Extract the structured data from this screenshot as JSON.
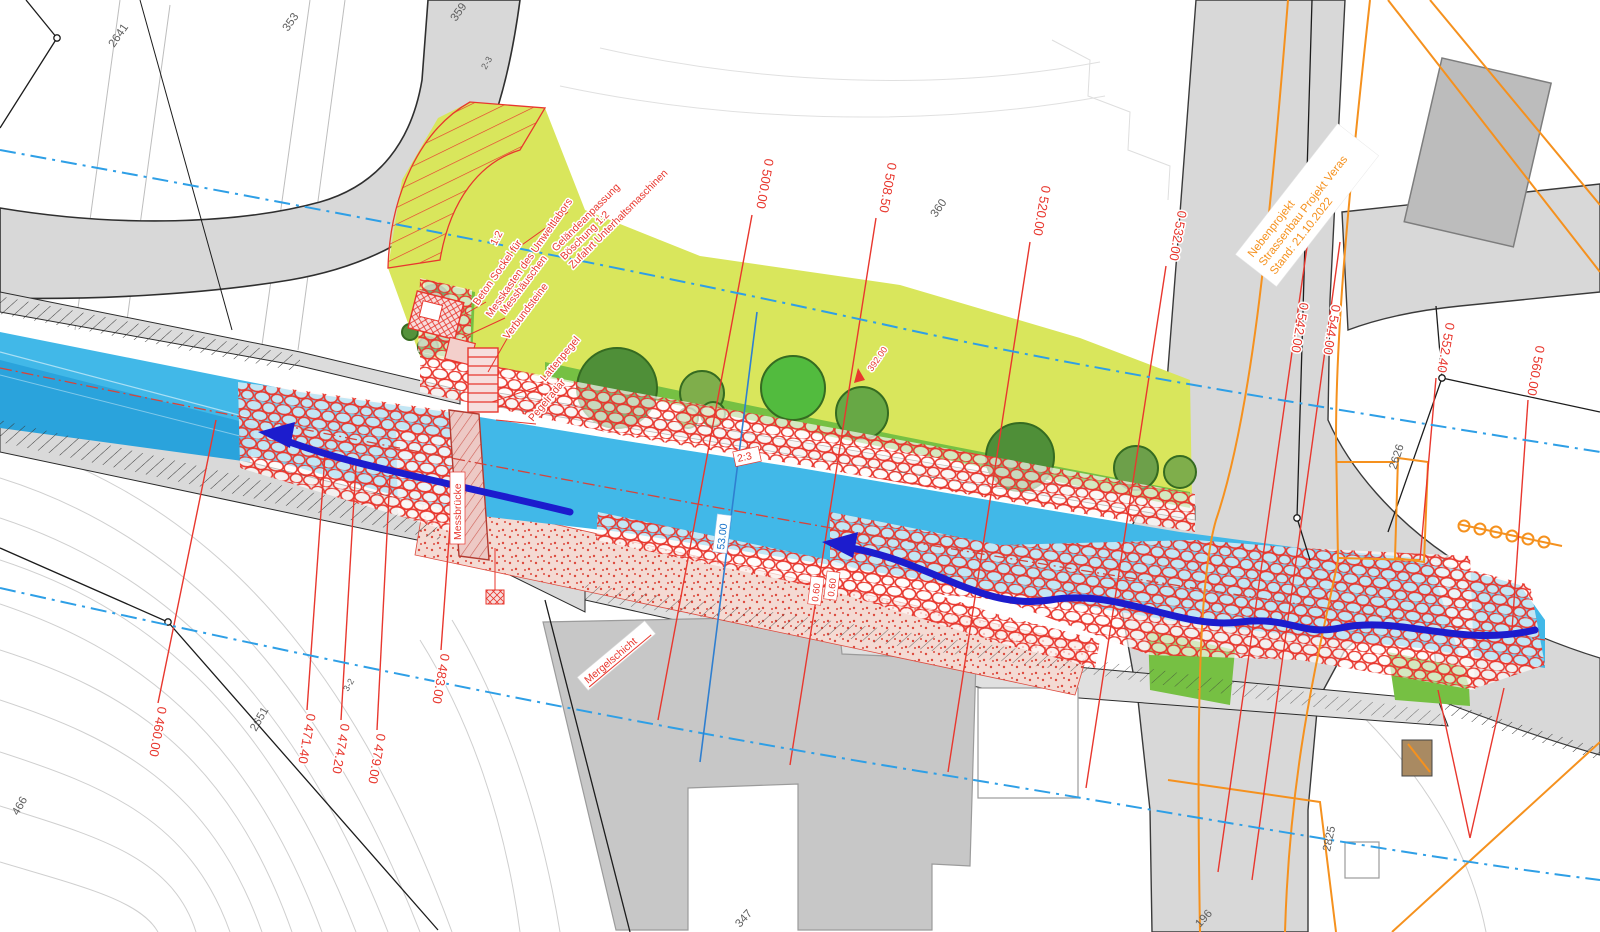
{
  "plan": {
    "kind": "civil-engineering river & bridge construction plan",
    "colors": {
      "river": "#41b8e8",
      "river_deep": "#2aa3dc",
      "vegetation": "#d9e65c",
      "grass": "#76c043",
      "road": "#d8d8d8",
      "building": "#bcbcbc",
      "red": "#e8372e",
      "orange": "#f5911e",
      "flow_arrow": "#1c1ccd",
      "axis_blue": "#2e9fe6"
    }
  },
  "note": {
    "line1": "Nebenprojekt",
    "line2": "Strassenbau Projekt Veras",
    "line3": "Stand: 21.10.2022"
  },
  "stations": {
    "s460": "0 460.00",
    "s471": "0 471.40",
    "s474": "0 474.20",
    "s479": "0 479.00",
    "s483": "0 483.00",
    "s500": "0 500.00",
    "s508": "0 508.50",
    "s520": "0 520.00",
    "s532": "0 532.00",
    "s542": "0 542.00",
    "s544": "0 544.00",
    "s552": "0 552.40",
    "s560": "0 560.00"
  },
  "parcels": {
    "p2641": "2641",
    "p353": "353",
    "p359": "359",
    "p23": "2-3",
    "p360": "360",
    "p2651": "2651",
    "p32": "3-2",
    "p466": "466",
    "p196": "196",
    "p2825": "2825",
    "p347": "347",
    "p2626": "2626"
  },
  "annotations": {
    "gelaende1": "Geländeanpassung",
    "gelaende2": "Böschung 1:2",
    "gelaende3": "Zufahrt Unterhaltsmaschinen",
    "slope12": "1:2",
    "beton1": "Beton Sockel für",
    "beton2": "Messkasten des Umweltlabors",
    "messhaeuschen": "Messhäuschen",
    "verbundsteine": "Verbundsteine",
    "lattenpegel": "Lattenpegel",
    "pegelradar": "Pegelradar",
    "messbruecke": "Messbrücke",
    "mergelschicht": "Mergelschicht",
    "spot_height": "392.00",
    "slope23": "2:3",
    "dim060a": "0.60",
    "dim060b": "0.60",
    "section": "53.00"
  }
}
